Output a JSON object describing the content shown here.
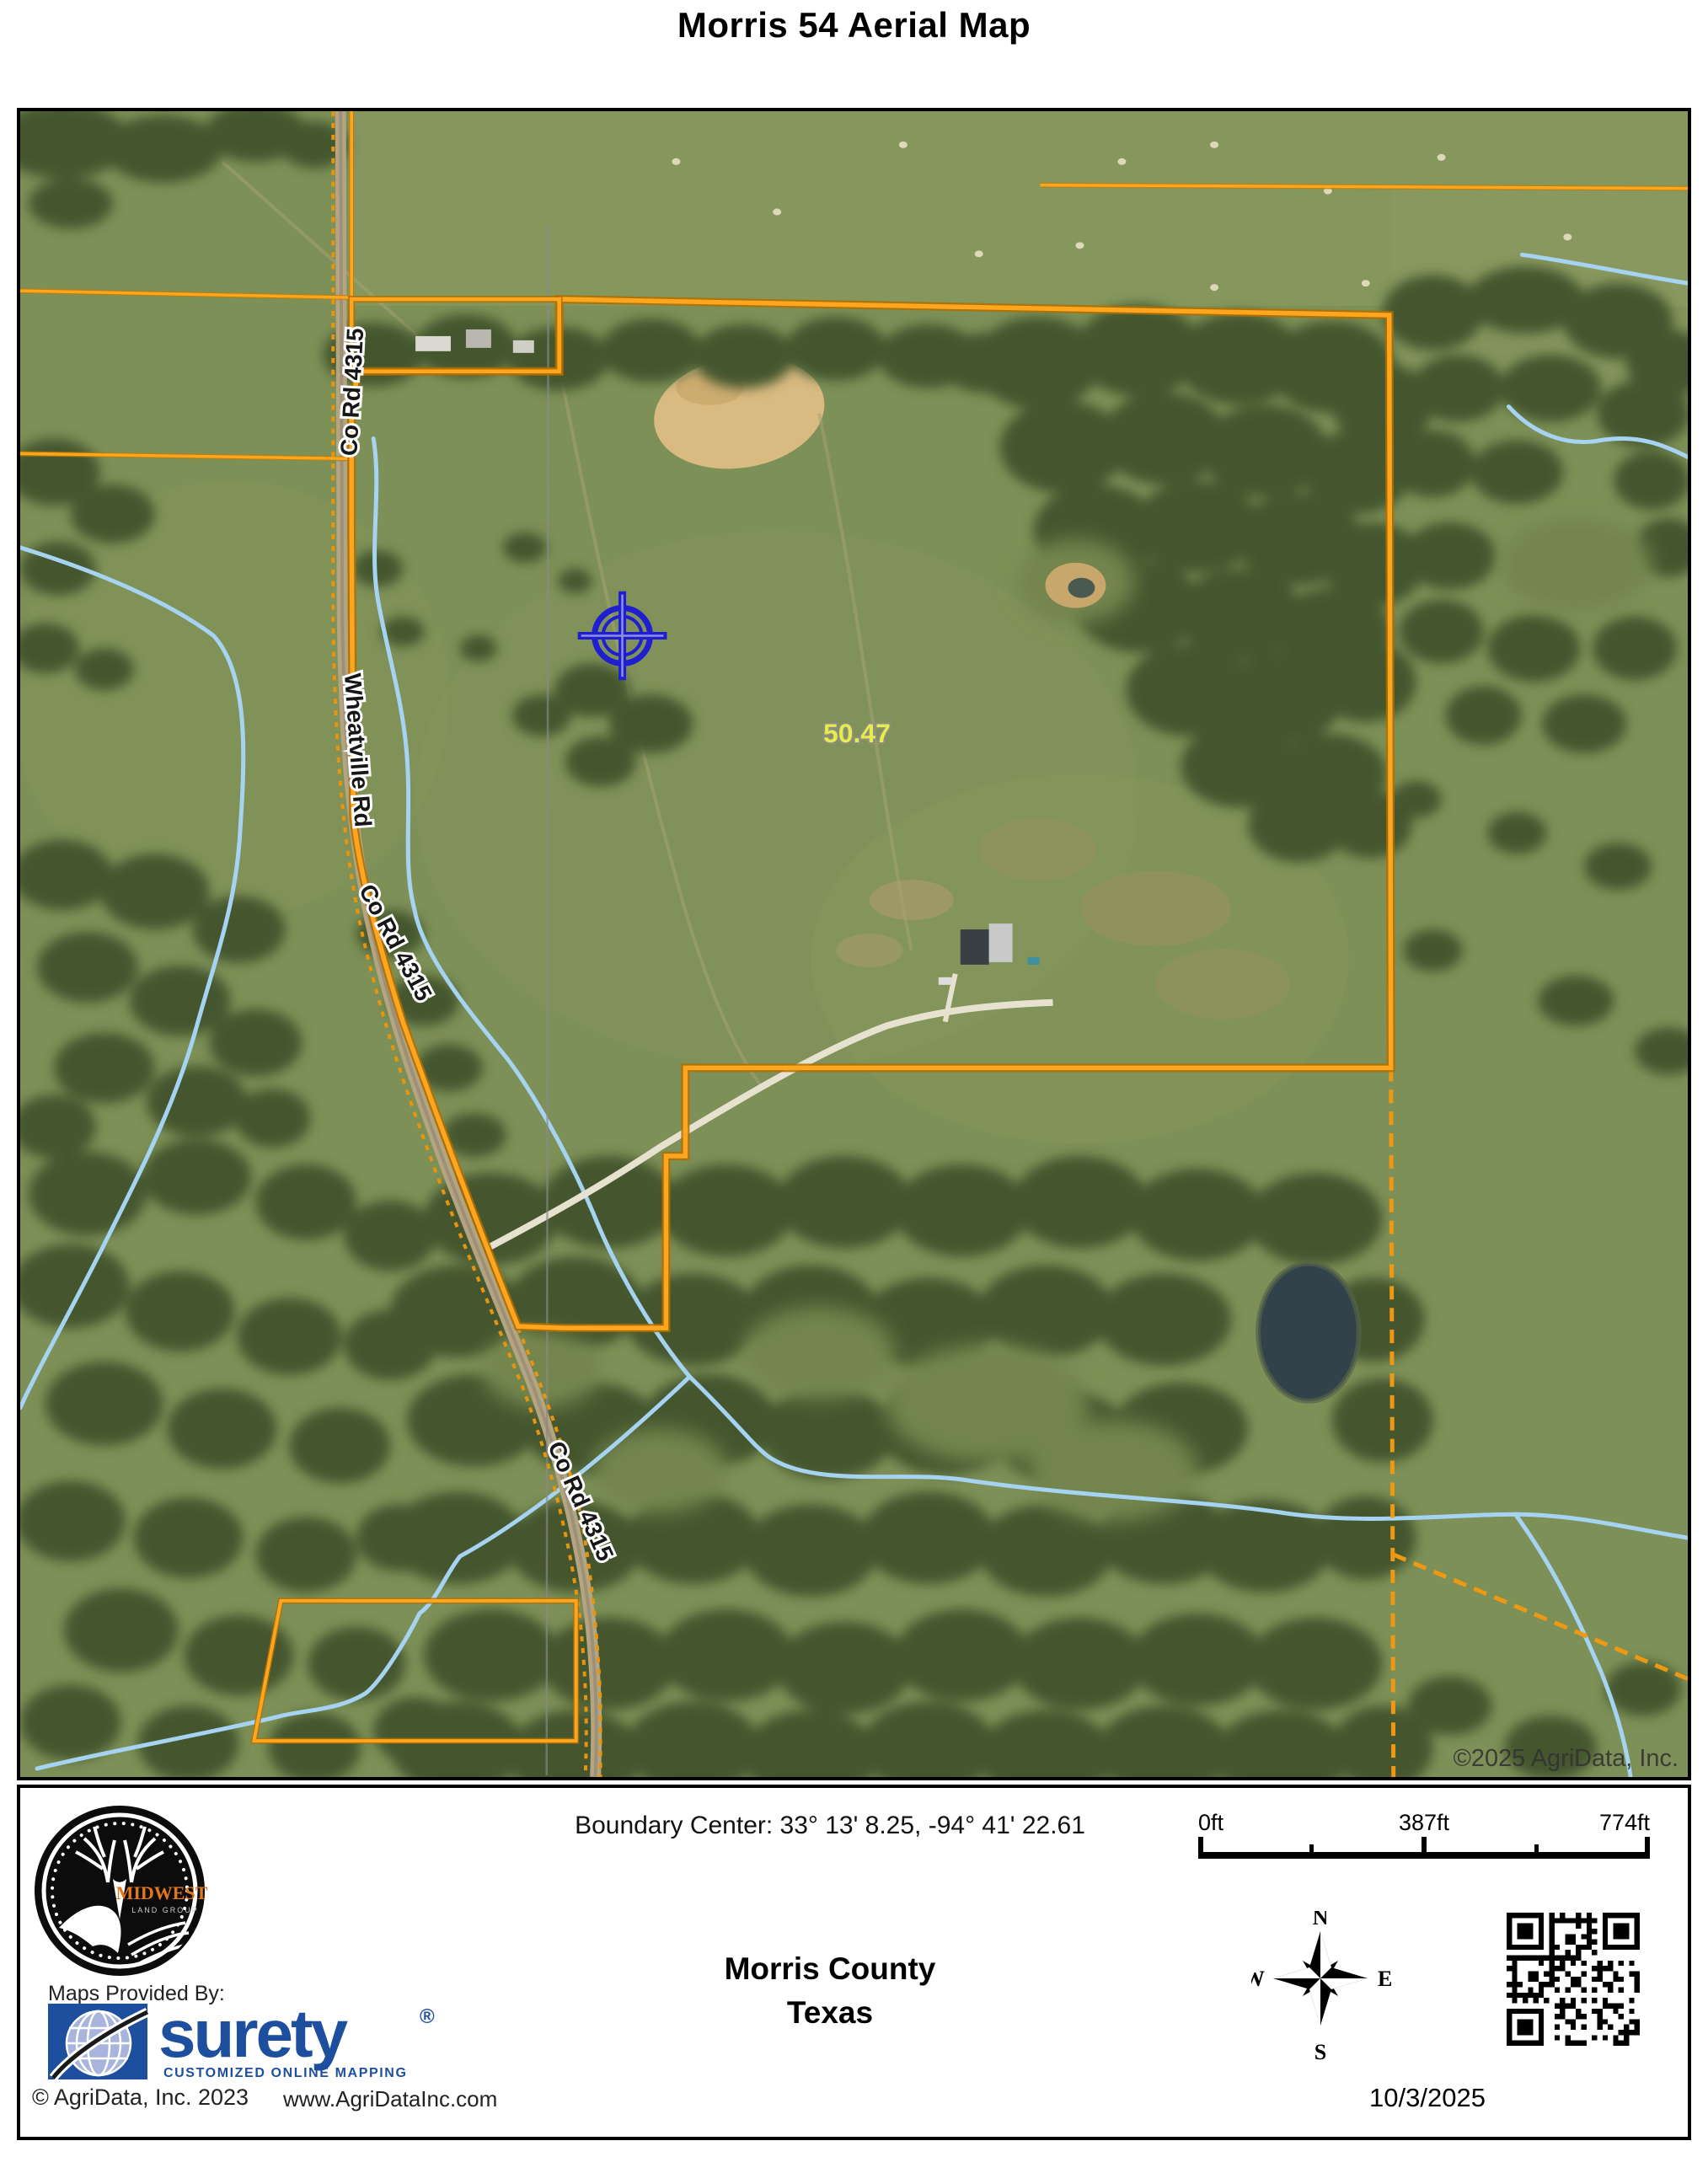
{
  "page": {
    "title": "Morris 54 Aerial Map"
  },
  "map": {
    "labels": {
      "co_rd_4315": "Co Rd 4315",
      "wheatville_rd": "Wheatville Rd",
      "acreage": "50.47"
    },
    "copyright": "©2025 AgriData, Inc.",
    "colors": {
      "boundary_orange": "#ffa51e",
      "creek_blue": "#a7d3f2",
      "crosshair_blue": "#1f1fd0",
      "acreage_yellow": "#e6ec4a",
      "pasture_green": "#7d9057",
      "forest_green": "#45562e"
    }
  },
  "footer": {
    "midwest": {
      "brand": "MIDWEST",
      "sub": "LAND GROUP"
    },
    "maps_provided_by": "Maps Provided By:",
    "surety": {
      "name": "surety",
      "registered": "®",
      "tagline": "CUSTOMIZED ONLINE MAPPING"
    },
    "agridata_copyright": "© AgriData, Inc. 2023",
    "agridata_url": "www.AgriDataInc.com",
    "boundary_center": "Boundary Center: 33° 13' 8.25,  -94° 41' 22.61",
    "county": "Morris County",
    "state": "Texas",
    "scale": {
      "start": "0ft",
      "mid": "387ft",
      "end": "774ft"
    },
    "compass": {
      "n": "N",
      "s": "S",
      "e": "E",
      "w": "W"
    },
    "date": "10/3/2025"
  }
}
